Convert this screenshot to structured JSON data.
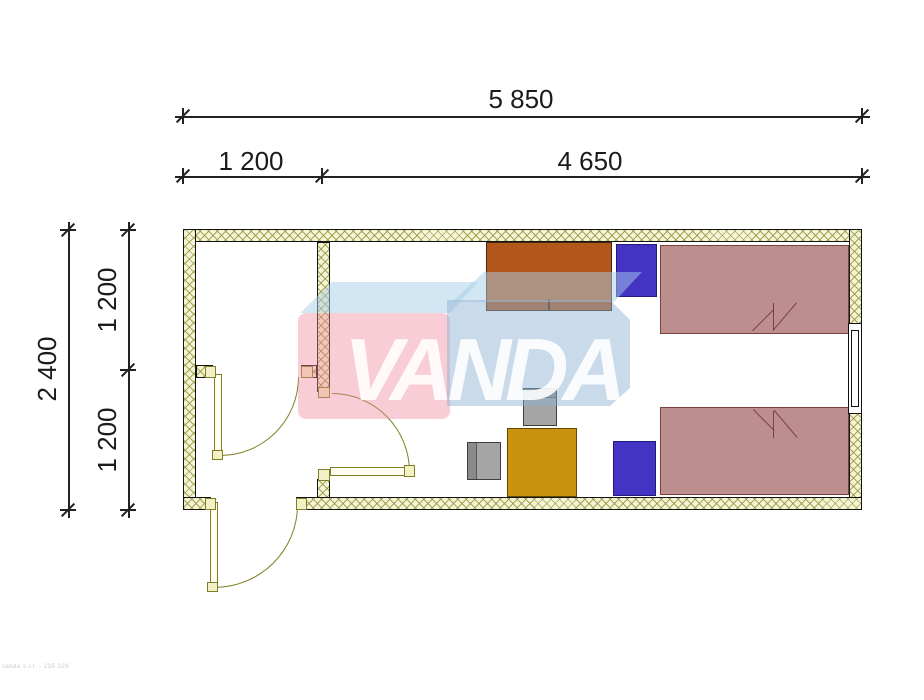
{
  "dimensions": {
    "top": [
      {
        "label": "5 850",
        "meaning": "total-width-mm"
      },
      {
        "label": "1 200",
        "meaning": "entry-width-mm"
      },
      {
        "label": "4 650",
        "meaning": "room-width-mm"
      }
    ],
    "left": [
      {
        "label": "2 400",
        "meaning": "total-depth-mm"
      },
      {
        "label": "1 200",
        "meaning": "upper-depth-mm"
      },
      {
        "label": "1 200",
        "meaning": "lower-depth-mm"
      }
    ]
  },
  "watermark": {
    "text": "VANDA",
    "pink_block_color": "#f2b9c4",
    "blue_block_color": "#c5d7e8",
    "top_face_color": "#d4e6f3",
    "text_color": "#ffffff"
  },
  "colors": {
    "wall_fill": "#f6f4d6",
    "wall_hatch": "#94983e",
    "wall_outline": "#141414",
    "door_symbol": "#7e7e22",
    "bed": "#bc8e8e",
    "bed_outline": "#7c4040",
    "nightstand": "#4334c4",
    "desk": "#c9930f",
    "chair": "#a5a5a5",
    "wardrobe": "#b2571c"
  },
  "furniture": [
    {
      "name": "wardrobe",
      "color": "#b2571c"
    },
    {
      "name": "nightstand-top",
      "color": "#4334c4"
    },
    {
      "name": "bed-top",
      "color": "#bc8e8e"
    },
    {
      "name": "bed-bottom",
      "color": "#bc8e8e"
    },
    {
      "name": "nightstand-bottom",
      "color": "#4334c4"
    },
    {
      "name": "desk",
      "color": "#c9930f"
    },
    {
      "name": "chair-left",
      "color": "#a5a5a5"
    },
    {
      "name": "chair-top",
      "color": "#a5a5a5"
    }
  ],
  "openings": {
    "doors": 3,
    "windows": 1
  },
  "footer": {
    "credit": "vanda s.r.l. - 235 328"
  }
}
